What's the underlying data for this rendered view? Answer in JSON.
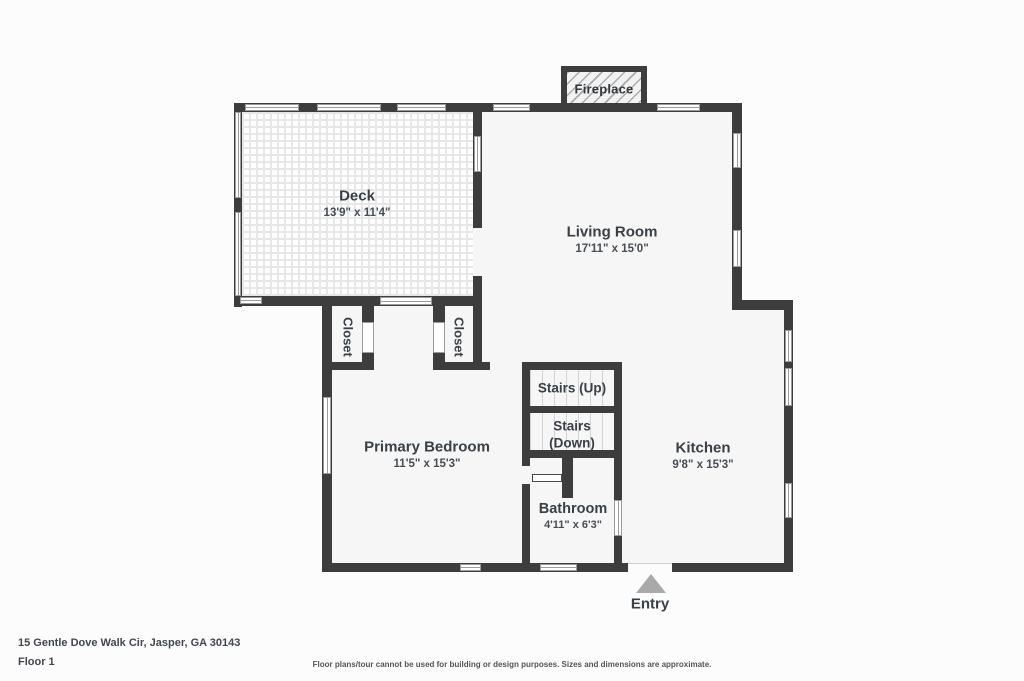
{
  "plan": {
    "rooms": {
      "deck": {
        "name": "Deck",
        "dims": "13'9\" x 11'4\""
      },
      "living_room": {
        "name": "Living Room",
        "dims": "17'11\" x 15'0\""
      },
      "primary_bedroom": {
        "name": "Primary Bedroom",
        "dims": "11'5\" x 15'3\""
      },
      "kitchen": {
        "name": "Kitchen",
        "dims": "9'8\" x 15'3\""
      },
      "bathroom": {
        "name": "Bathroom",
        "dims": "4'11\" x 6'3\""
      },
      "closet_left": {
        "name": "Closet"
      },
      "closet_right": {
        "name": "Closet"
      },
      "stairs_up": {
        "name": "Stairs (Up)"
      },
      "stairs_down": {
        "line1": "Stairs",
        "line2": "(Down)"
      },
      "fireplace": {
        "name": "Fireplace"
      },
      "entry": {
        "name": "Entry"
      }
    },
    "footer": {
      "address": "15 Gentle Dove Walk Cir, Jasper, GA 30143",
      "floor": "Floor 1",
      "disclaimer": "Floor plans/tour cannot be used for building or design purposes. Sizes and dimensions are approximate."
    },
    "colors": {
      "wall": "#3d3d3d",
      "floor": "#f6f6f6",
      "entry_arrow": "#a9a9a9",
      "label": "#3a4046"
    }
  }
}
